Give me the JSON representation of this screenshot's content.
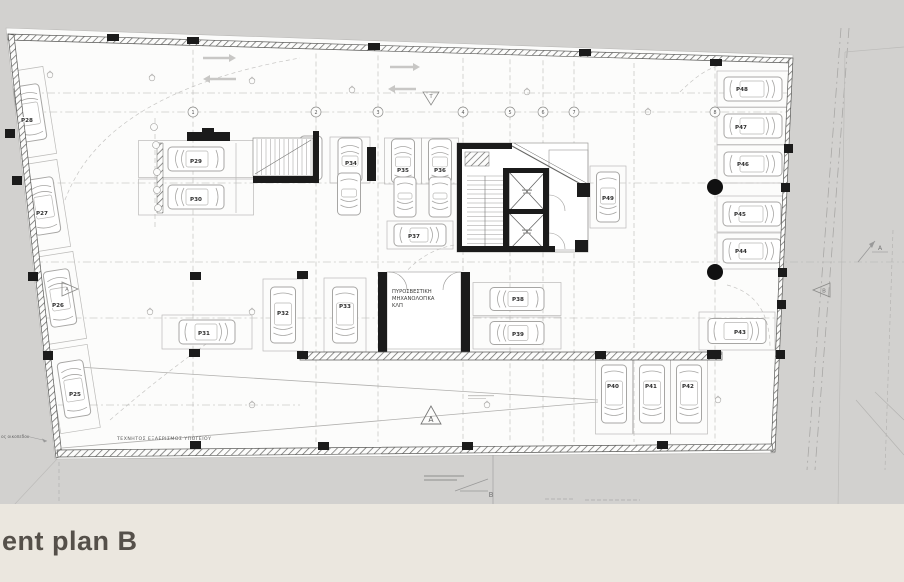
{
  "footer": {
    "title": "ent plan B",
    "bg": "#ebe7df",
    "text_color": "#55504a"
  },
  "colors": {
    "canvas": "#d2d1cf",
    "paper": "#fcfcfb",
    "wall": "#1b1b1b",
    "line_light": "#c6c5c3",
    "line_mid": "#9b9a98",
    "car": "#a7a6a4",
    "label": "#2d2d2d",
    "note": "#555555",
    "marker": "#8a8a88"
  },
  "plan": {
    "spots": [
      {
        "id": "P28",
        "cx": 30,
        "cy": 113,
        "rot": -9,
        "sw": 40,
        "sh": 88,
        "dir": "up",
        "len": 56,
        "w": 26,
        "lx": 27,
        "ly": 120
      },
      {
        "id": "P27",
        "cx": 44,
        "cy": 206,
        "rot": -9,
        "sw": 40,
        "sh": 88,
        "dir": "up",
        "len": 56,
        "w": 26,
        "lx": 42,
        "ly": 213
      },
      {
        "id": "P26",
        "cx": 60,
        "cy": 298,
        "rot": -9,
        "sw": 40,
        "sh": 88,
        "dir": "up",
        "len": 56,
        "w": 26,
        "lx": 58,
        "ly": 305
      },
      {
        "id": "P25",
        "cx": 74,
        "cy": 389,
        "rot": -9,
        "sw": 40,
        "sh": 84,
        "dir": "up",
        "len": 56,
        "w": 26,
        "lx": 75,
        "ly": 394
      },
      {
        "id": "P29",
        "cx": 196,
        "cy": 159,
        "rot": 0,
        "sw": 115,
        "sh": 37,
        "dir": "left",
        "len": 56,
        "w": 24,
        "lx": 196,
        "ly": 161
      },
      {
        "id": "P30",
        "cx": 196,
        "cy": 197,
        "rot": 0,
        "sw": 115,
        "sh": 36,
        "dir": "left",
        "len": 56,
        "w": 24,
        "lx": 196,
        "ly": 199
      },
      {
        "id": "P34",
        "cx": 350,
        "cy": 160,
        "rot": 0,
        "sw": 40,
        "sh": 46,
        "dir": "up",
        "len": 44,
        "w": 24,
        "lx": 351,
        "ly": 163
      },
      {
        "id": "P35",
        "cx": 403,
        "cy": 161,
        "rot": 0,
        "sw": 37,
        "sh": 46,
        "dir": "up",
        "len": 44,
        "w": 23,
        "lx": 403,
        "ly": 170
      },
      {
        "id": "P36",
        "cx": 440,
        "cy": 161,
        "rot": 0,
        "sw": 37,
        "sh": 46,
        "dir": "up",
        "len": 44,
        "w": 23,
        "lx": 440,
        "ly": 170
      },
      {
        "id": "P37",
        "cx": 420,
        "cy": 235,
        "rot": 0,
        "sw": 66,
        "sh": 28,
        "dir": "right",
        "len": 52,
        "w": 22,
        "lx": 414,
        "ly": 236
      },
      {
        "id": "P31",
        "cx": 207,
        "cy": 332,
        "rot": 0,
        "sw": 90,
        "sh": 34,
        "dir": "right",
        "len": 56,
        "w": 24,
        "lx": 204,
        "ly": 333
      },
      {
        "id": "P32",
        "cx": 283,
        "cy": 315,
        "rot": 0,
        "sw": 40,
        "sh": 72,
        "dir": "down",
        "len": 56,
        "w": 25,
        "lx": 283,
        "ly": 313
      },
      {
        "id": "P33",
        "cx": 345,
        "cy": 315,
        "rot": 0,
        "sw": 42,
        "sh": 74,
        "dir": "down",
        "len": 56,
        "w": 25,
        "lx": 345,
        "ly": 306
      },
      {
        "id": "P38",
        "cx": 517,
        "cy": 299,
        "rot": 0,
        "sw": 88,
        "sh": 33,
        "dir": "left",
        "len": 54,
        "w": 23,
        "lx": 518,
        "ly": 299
      },
      {
        "id": "P39",
        "cx": 517,
        "cy": 333,
        "rot": 0,
        "sw": 88,
        "sh": 32,
        "dir": "left",
        "len": 54,
        "w": 23,
        "lx": 518,
        "ly": 334
      },
      {
        "id": "P40",
        "cx": 614,
        "cy": 394,
        "rot": 0,
        "sw": 37,
        "sh": 80,
        "dir": "down",
        "len": 58,
        "w": 25,
        "lx": 613,
        "ly": 386
      },
      {
        "id": "P41",
        "cx": 652,
        "cy": 394,
        "rot": 0,
        "sw": 37,
        "sh": 80,
        "dir": "down",
        "len": 58,
        "w": 25,
        "lx": 651,
        "ly": 386
      },
      {
        "id": "P42",
        "cx": 689,
        "cy": 394,
        "rot": 0,
        "sw": 37,
        "sh": 80,
        "dir": "down",
        "len": 58,
        "w": 25,
        "lx": 688,
        "ly": 386
      },
      {
        "id": "P43",
        "cx": 737,
        "cy": 331,
        "rot": 0,
        "sw": 76,
        "sh": 38,
        "dir": "right",
        "len": 58,
        "w": 25,
        "lx": 740,
        "ly": 332
      },
      {
        "id": "P44",
        "cx": 752,
        "cy": 251,
        "rot": 0,
        "sw": 70,
        "sh": 36,
        "dir": "right",
        "len": 58,
        "w": 24,
        "lx": 741,
        "ly": 251
      },
      {
        "id": "P45",
        "cx": 752,
        "cy": 214,
        "rot": 0,
        "sw": 70,
        "sh": 36,
        "dir": "right",
        "len": 58,
        "w": 24,
        "lx": 740,
        "ly": 214
      },
      {
        "id": "P46",
        "cx": 753,
        "cy": 164,
        "rot": 0,
        "sw": 72,
        "sh": 38,
        "dir": "right",
        "len": 58,
        "w": 24,
        "lx": 743,
        "ly": 164
      },
      {
        "id": "P47",
        "cx": 753,
        "cy": 126,
        "rot": 0,
        "sw": 72,
        "sh": 37,
        "dir": "right",
        "len": 58,
        "w": 24,
        "lx": 741,
        "ly": 127
      },
      {
        "id": "P48",
        "cx": 753,
        "cy": 89,
        "rot": 0,
        "sw": 72,
        "sh": 36,
        "dir": "right",
        "len": 58,
        "w": 24,
        "lx": 742,
        "ly": 89
      },
      {
        "id": "P49",
        "cx": 608,
        "cy": 197,
        "rot": 0,
        "sw": 36,
        "sh": 62,
        "dir": "down",
        "len": 50,
        "w": 23,
        "lx": 608,
        "ly": 198
      }
    ],
    "extra_cars": [
      {
        "cx": 349,
        "cy": 194,
        "dir": "down",
        "len": 42,
        "w": 23
      },
      {
        "cx": 405,
        "cy": 197,
        "dir": "down",
        "len": 40,
        "w": 22
      },
      {
        "cx": 440,
        "cy": 197,
        "dir": "down",
        "len": 40,
        "w": 22
      },
      {
        "cx": 311,
        "cy": 158,
        "dir": "up",
        "len": 44,
        "w": 22
      }
    ],
    "grid_cols": [
      {
        "x": 155,
        "n": "",
        "y1": 118,
        "y2": 228
      },
      {
        "x": 193,
        "n": "1"
      },
      {
        "x": 316,
        "n": "2"
      },
      {
        "x": 378,
        "n": "3"
      },
      {
        "x": 463,
        "n": "4"
      },
      {
        "x": 510,
        "n": "5"
      },
      {
        "x": 543,
        "n": "6"
      },
      {
        "x": 574,
        "n": "7"
      },
      {
        "x": 634,
        "n": ""
      },
      {
        "x": 715,
        "n": "8"
      }
    ],
    "grid_rows": [
      93,
      112,
      183,
      262,
      318
    ],
    "grid_rows_partial": [
      {
        "y": 405,
        "x1": 58,
        "x2": 300
      }
    ],
    "side_bubbles": [
      [
        154,
        127
      ],
      [
        156,
        145
      ],
      [
        157,
        172
      ],
      [
        157,
        190
      ],
      [
        158,
        208
      ]
    ],
    "vents": [
      [
        50,
        75
      ],
      [
        152,
        78
      ],
      [
        252,
        81
      ],
      [
        352,
        90
      ],
      [
        527,
        92
      ],
      [
        648,
        112
      ],
      [
        150,
        312
      ],
      [
        252,
        312
      ],
      [
        252,
        405
      ],
      [
        487,
        405
      ],
      [
        718,
        400
      ]
    ],
    "filled_circles": [
      [
        715,
        187
      ],
      [
        715,
        272
      ]
    ],
    "notes": {
      "fire_room_lines": [
        "ΠΥΡΟΣΒΕΣΤΙΚΗ",
        "ΜΗΧΑΝΟΛΟΓΙΚΑ",
        "ΚΛΠ"
      ],
      "ventilation": "ΤΕΧΝΗΤΟΣ ΕΞΑΕΡΙΣΜΟΣ ΥΠΟΓΕΙΟΥ",
      "plot_boundary": "ος οικοπεδου"
    },
    "markers": [
      {
        "id": "T",
        "x": 431,
        "y": 97,
        "shape": "tri-down"
      },
      {
        "id": "A",
        "x": 69,
        "y": 289,
        "shape": "tri-right"
      },
      {
        "id": "A",
        "x": 431,
        "y": 417,
        "shape": "tri-up-large"
      },
      {
        "id": "B",
        "x": 821,
        "y": 290,
        "shape": "tri-left"
      },
      {
        "id": "A",
        "x": 878,
        "y": 250,
        "shape": "arrow-ne"
      },
      {
        "id": "B",
        "x": 491,
        "y": 497,
        "shape": "slope"
      }
    ]
  }
}
